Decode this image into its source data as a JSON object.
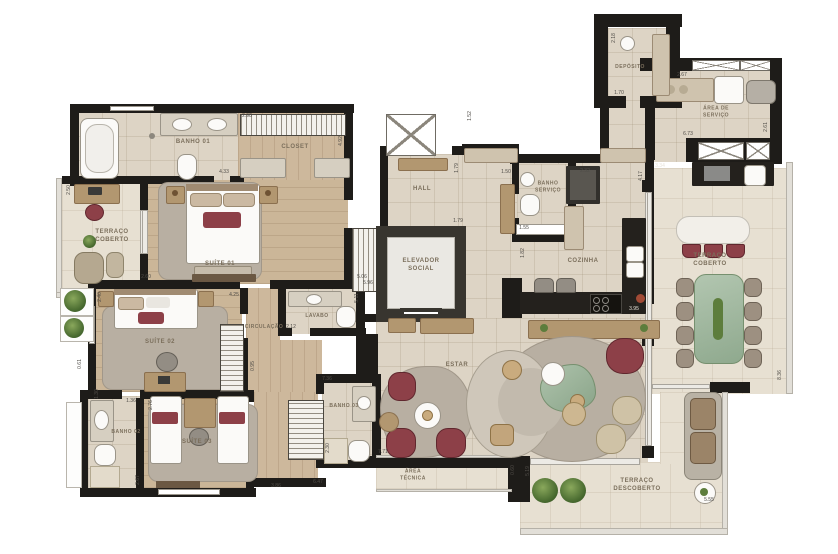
{
  "plan": {
    "kind": "apartment floor plan (top view)"
  },
  "rooms": {
    "banho01": "BANHO 01",
    "closet": "CLOSET",
    "terraco_coberto_esq": "TERRAÇO\nCOBERTO",
    "suite01": "SUÍTE 01",
    "suite02": "SUÍTE 02",
    "suite03": "SUÍTE 03",
    "banho02": "BANHO 02",
    "banho03": "BANHO 03",
    "circulacao": "CIRCULAÇÃO",
    "lavabo": "LAVABO",
    "hall": "HALL",
    "elevador_social": "ELEVADOR\nSOCIAL",
    "estar": "ESTAR",
    "cozinha": "COZINHA",
    "banho_servico": "BANHO\nSERVIÇO",
    "deposito": "DEPÓSITO",
    "area_servico": "ÁREA DE\nSERVIÇO",
    "terraco_coberto_dir": "TERRAÇO\nCOBERTO",
    "area_tecnica": "ÁREA\nTÉCNICA",
    "terraco_descoberto": "TERRAÇO\nDESCOBERTO"
  },
  "dims": [
    "2.98",
    "4.92",
    "4.33",
    "2.60",
    "5.06",
    "4.25",
    "2.40",
    "0.61",
    "1.36",
    "2.76",
    "2.12",
    "0.95",
    "5.96",
    "5.11",
    "7.36",
    "2.30",
    "3.86",
    "6.47",
    "2.67",
    "1.30",
    "7.71",
    "0.60",
    "5.19",
    "5.55",
    "3.95",
    "1.82",
    "1.55",
    "1.50",
    "2.32",
    "1.79",
    "1.79",
    "1.52",
    "1.70",
    "2.18",
    "2.67",
    "2.61",
    "6.73",
    "3.34",
    "4.17",
    "8.36",
    "2.50"
  ],
  "colors": {
    "wall": "#1e1c19",
    "maroon_accent": "#8d4048",
    "green_marble": "#a4bca3",
    "wood_floor": "#cdb89c",
    "tile_floor": "#ddd4c5",
    "terrace_floor": "#e7e0d2",
    "plant_green": "#5d7d3c",
    "counter_black": "#24211d"
  }
}
